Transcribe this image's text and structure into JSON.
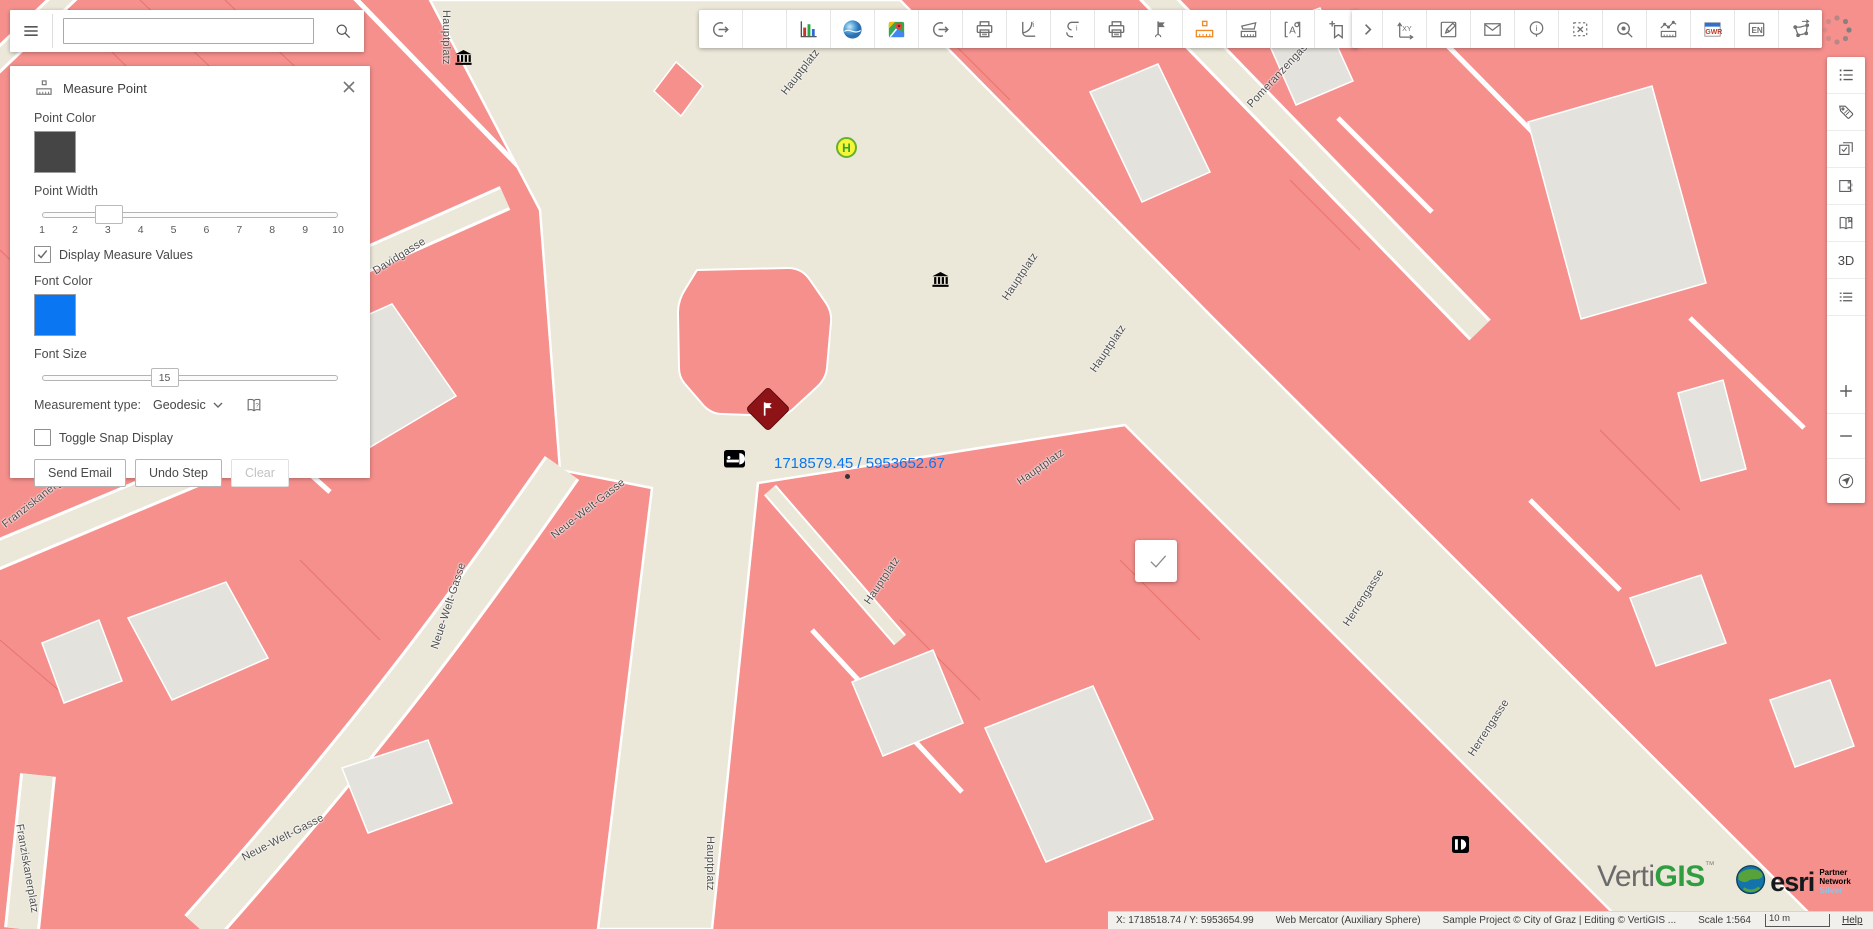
{
  "header": {
    "search_placeholder": ""
  },
  "measure_panel": {
    "title": "Measure Point",
    "point_color": {
      "label": "Point Color",
      "value": "#454545"
    },
    "point_width": {
      "label": "Point Width",
      "value": 3,
      "min": 1,
      "max": 10,
      "ticks": [
        "1",
        "2",
        "3",
        "4",
        "5",
        "6",
        "7",
        "8",
        "9",
        "10"
      ]
    },
    "display_measure_values": {
      "label": "Display Measure Values",
      "checked": true
    },
    "font_color": {
      "label": "Font Color",
      "value": "#0b76f2"
    },
    "font_size": {
      "label": "Font Size",
      "value": "15",
      "position_pct": 41
    },
    "measurement_type": {
      "label": "Measurement type:",
      "value": "Geodesic"
    },
    "toggle_snap": {
      "label": "Toggle Snap Display",
      "checked": false
    },
    "buttons": [
      {
        "label": "Send Email",
        "enabled": true
      },
      {
        "label": "Undo Step",
        "enabled": true
      },
      {
        "label": "Clear",
        "enabled": false
      }
    ]
  },
  "toolbar_main": [
    "export-icon",
    "blank-icon",
    "chart-icon",
    "earth-icon",
    "maps-icon",
    "export-alt-icon",
    "print-icon",
    "report-icon",
    "report-alt-icon",
    "print-alt-icon",
    "flag-icon",
    "measure-point-icon",
    "measure-area-icon",
    "label-icon",
    "bookmark-add-icon"
  ],
  "toolbar_more": [
    "expand-icon",
    "goto-xy-icon",
    "edit-form-icon",
    "email-icon",
    "info-icon",
    "clear-selection-icon",
    "zoomto-icon",
    "profile-icon",
    "gwr-icon",
    "language-icon",
    "transform-icon"
  ],
  "toolbar_active_tool": "measure-point-icon",
  "sidebar": {
    "top_items": [
      "layer-list-icon",
      "tag-icon",
      "select-features-icon",
      "swatch-icon",
      "book-icon",
      "threed-button",
      "list-icon"
    ],
    "threed_label": "3D",
    "zoom_items": [
      "zoom-in-icon",
      "zoom-out-icon",
      "locate-icon"
    ]
  },
  "map": {
    "measure_label": "1718579.45 / 5953652.67",
    "bus_stop_letter": "H",
    "street_labels": [
      {
        "text": "Hauptplatz",
        "x": 452,
        "y": 10,
        "rot": 90
      },
      {
        "text": "Hauptplatz",
        "x": 779,
        "y": 90,
        "rot": -52
      },
      {
        "text": "Pomeranzengasse",
        "x": 1245,
        "y": 102,
        "rot": -47
      },
      {
        "text": "Davidgasse",
        "x": 371,
        "y": 267,
        "rot": -32
      },
      {
        "text": "Hauptplatz",
        "x": 1000,
        "y": 296,
        "rot": -56
      },
      {
        "text": "Hauptplatz",
        "x": 1088,
        "y": 368,
        "rot": -56
      },
      {
        "text": "Hauptplatz",
        "x": 1015,
        "y": 478,
        "rot": -35
      },
      {
        "text": "Neue-Welt-Gasse",
        "x": 549,
        "y": 532,
        "rot": -38
      },
      {
        "text": "Franziskanergasse",
        "x": 0,
        "y": 521,
        "rot": -38
      },
      {
        "text": "Hauptplatz",
        "x": 862,
        "y": 600,
        "rot": -56
      },
      {
        "text": "Herrengasse",
        "x": 1341,
        "y": 622,
        "rot": -57
      },
      {
        "text": "Neue-Welt-Gasse",
        "x": 429,
        "y": 647,
        "rot": -72
      },
      {
        "text": "Herrengasse",
        "x": 1466,
        "y": 752,
        "rot": -57
      },
      {
        "text": "Neue-Welt-Gasse",
        "x": 240,
        "y": 853,
        "rot": -27
      },
      {
        "text": "Hauptplatz",
        "x": 716,
        "y": 836,
        "rot": 90
      },
      {
        "text": "Franziskanerplatz",
        "x": 25,
        "y": 823,
        "rot": 80
      }
    ]
  },
  "statusbar": {
    "pointer_coords": "X: 1718518.74 / Y: 5953654.99",
    "projection": "Web Mercator (Auxiliary Sphere)",
    "attribution": "Sample Project © City of Graz | Editing © VertiGIS ...",
    "scale": "Scale 1:564",
    "scalebar_label": "10 m",
    "links": [
      "Help",
      "Legal",
      "Sign out"
    ]
  },
  "branding": {
    "vertigis_prefix": "Verti",
    "vertigis_suffix": "GIS",
    "trademark": "™",
    "esri_label": "esri",
    "partner_line1": "Partner Network",
    "partner_line2": "Silver"
  },
  "colors": {
    "map_pink": "#f5908d",
    "map_beige": "#ebe7d9",
    "map_gray_building": "#e4e2dc",
    "accent_orange": "#ef8b27",
    "measure_blue": "#0b76f2"
  }
}
